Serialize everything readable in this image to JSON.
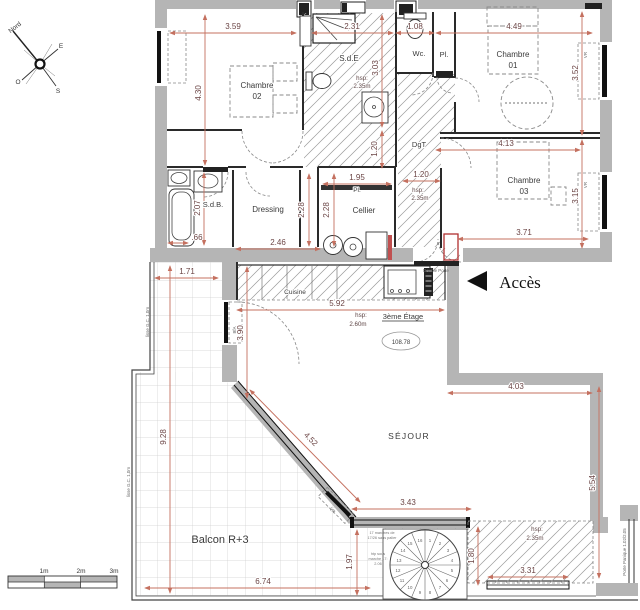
{
  "colors": {
    "wall": "#b5b5b5",
    "dim_line": "#c4705f",
    "dim_text": "#6b4545",
    "hatch": "#9a9a9a",
    "accent_red": "#b03030"
  },
  "compass": {
    "north": "Nord",
    "east": "E",
    "south": "S",
    "west": "O"
  },
  "scale_bar": {
    "m1": "1m",
    "m2": "2m",
    "m3": "3m"
  },
  "floor": {
    "label": "3ème Étage",
    "area": "108.78"
  },
  "entry": {
    "acces": "Accès",
    "double_porte": "Double Porte"
  },
  "rooms": {
    "chambre01": {
      "l1": "Chambre",
      "l2": "01"
    },
    "chambre02": {
      "l1": "Chambre",
      "l2": "02"
    },
    "chambre03": {
      "l1": "Chambre",
      "l2": "03"
    },
    "sde": {
      "name": "S.d.E",
      "hsp1": "hsp:",
      "hsp2": "2.35m"
    },
    "sdb": {
      "name": "S.d.B."
    },
    "wc": {
      "name": "Wc."
    },
    "pl_top": {
      "name": "Pl."
    },
    "pl_cellier": {
      "name": "Pl."
    },
    "dgt": {
      "name": "DgT"
    },
    "dressing": {
      "name": "Dressing"
    },
    "cellier": {
      "name": "Cellier"
    },
    "cuisine": {
      "name": "Cuisine",
      "hsp1": "hsp:",
      "hsp2": "2.60m"
    },
    "sejour": {
      "name": "SÉJOUR"
    },
    "balcon": {
      "name": "Balcon R+3"
    },
    "loggia": {
      "hsp1": "hsp:",
      "hsp2": "2.35m"
    }
  },
  "dims": {
    "d359": "3.59",
    "d231": "2.31",
    "d108": "1.08",
    "d449": "4.49",
    "d430": "4.30",
    "d303": "3.03",
    "d120v": "1.20",
    "d352": "3.52",
    "d315": "3.15",
    "d413": "4.13",
    "d371": "3.71",
    "d120h": "1.20",
    "d207": "2.07",
    "d066": ".66",
    "d246": "2.46",
    "d228a": "2.28",
    "d228b": "2.28",
    "d195": "1.95",
    "d171": "1.71",
    "d592": "5.92",
    "d390": "3.90",
    "d403": "4.03",
    "d554": "5.54",
    "d343": "3.43",
    "d452": "4.52",
    "d928": "9.28",
    "d674": "6.74",
    "d197": "1.97",
    "d180": "1.80",
    "d331": "3.31"
  },
  "windows": {
    "vr1": "VR",
    "vr2": "VR",
    "vr3": "VR",
    "bfa": "BfA",
    "porte": "Porte Panique 1.02/2.05"
  },
  "railings": {
    "r1": "lisse G.C. 1,0m",
    "r2": "lisse G.C. 1,0m"
  },
  "stair": {
    "steps": [
      "1",
      "2",
      "3",
      "4",
      "5",
      "6",
      "7",
      "8",
      "9",
      "10",
      "11",
      "12",
      "13",
      "14",
      "15",
      "16"
    ],
    "note1": "17 marches de",
    "note2": "17/26 sans palier",
    "note3": "htp sous",
    "note4": "marche 17:",
    "note5": "2.06"
  }
}
